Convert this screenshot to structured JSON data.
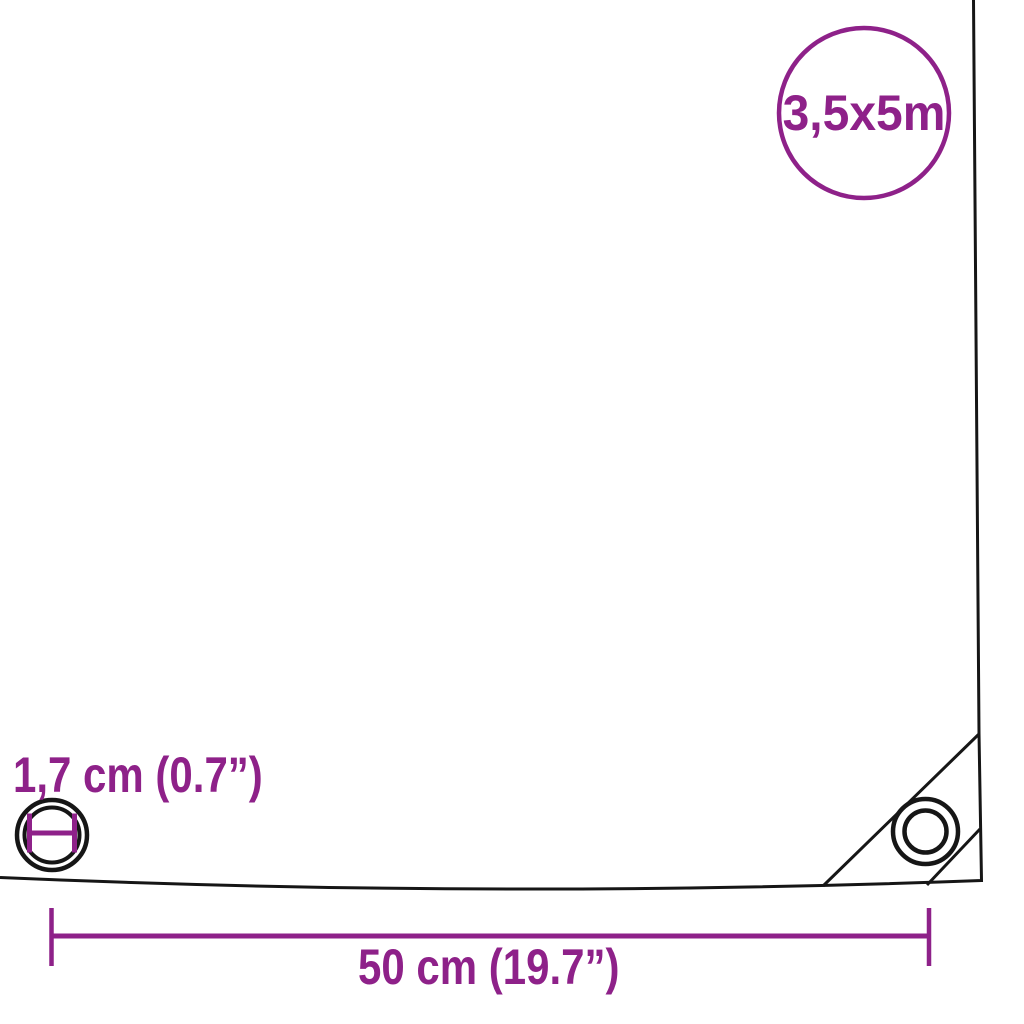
{
  "badge": {
    "size_label": "3,5x5m"
  },
  "eyelet": {
    "diameter_label": "1,7 cm (0.7”)"
  },
  "grommet_spacing": {
    "label": "50 cm (19.7”)"
  },
  "colors": {
    "accent_purple": "#8E2189",
    "outline_black": "#161616",
    "background": "#FFFFFF"
  },
  "icons": {
    "size_badge": "circle-outline-badge",
    "eyelet_diagram": "double-circle-with-diameter-measure",
    "corner_grommet": "double-circle-ring",
    "spacing_dimension": "horizontal-line-with-end-ticks"
  }
}
